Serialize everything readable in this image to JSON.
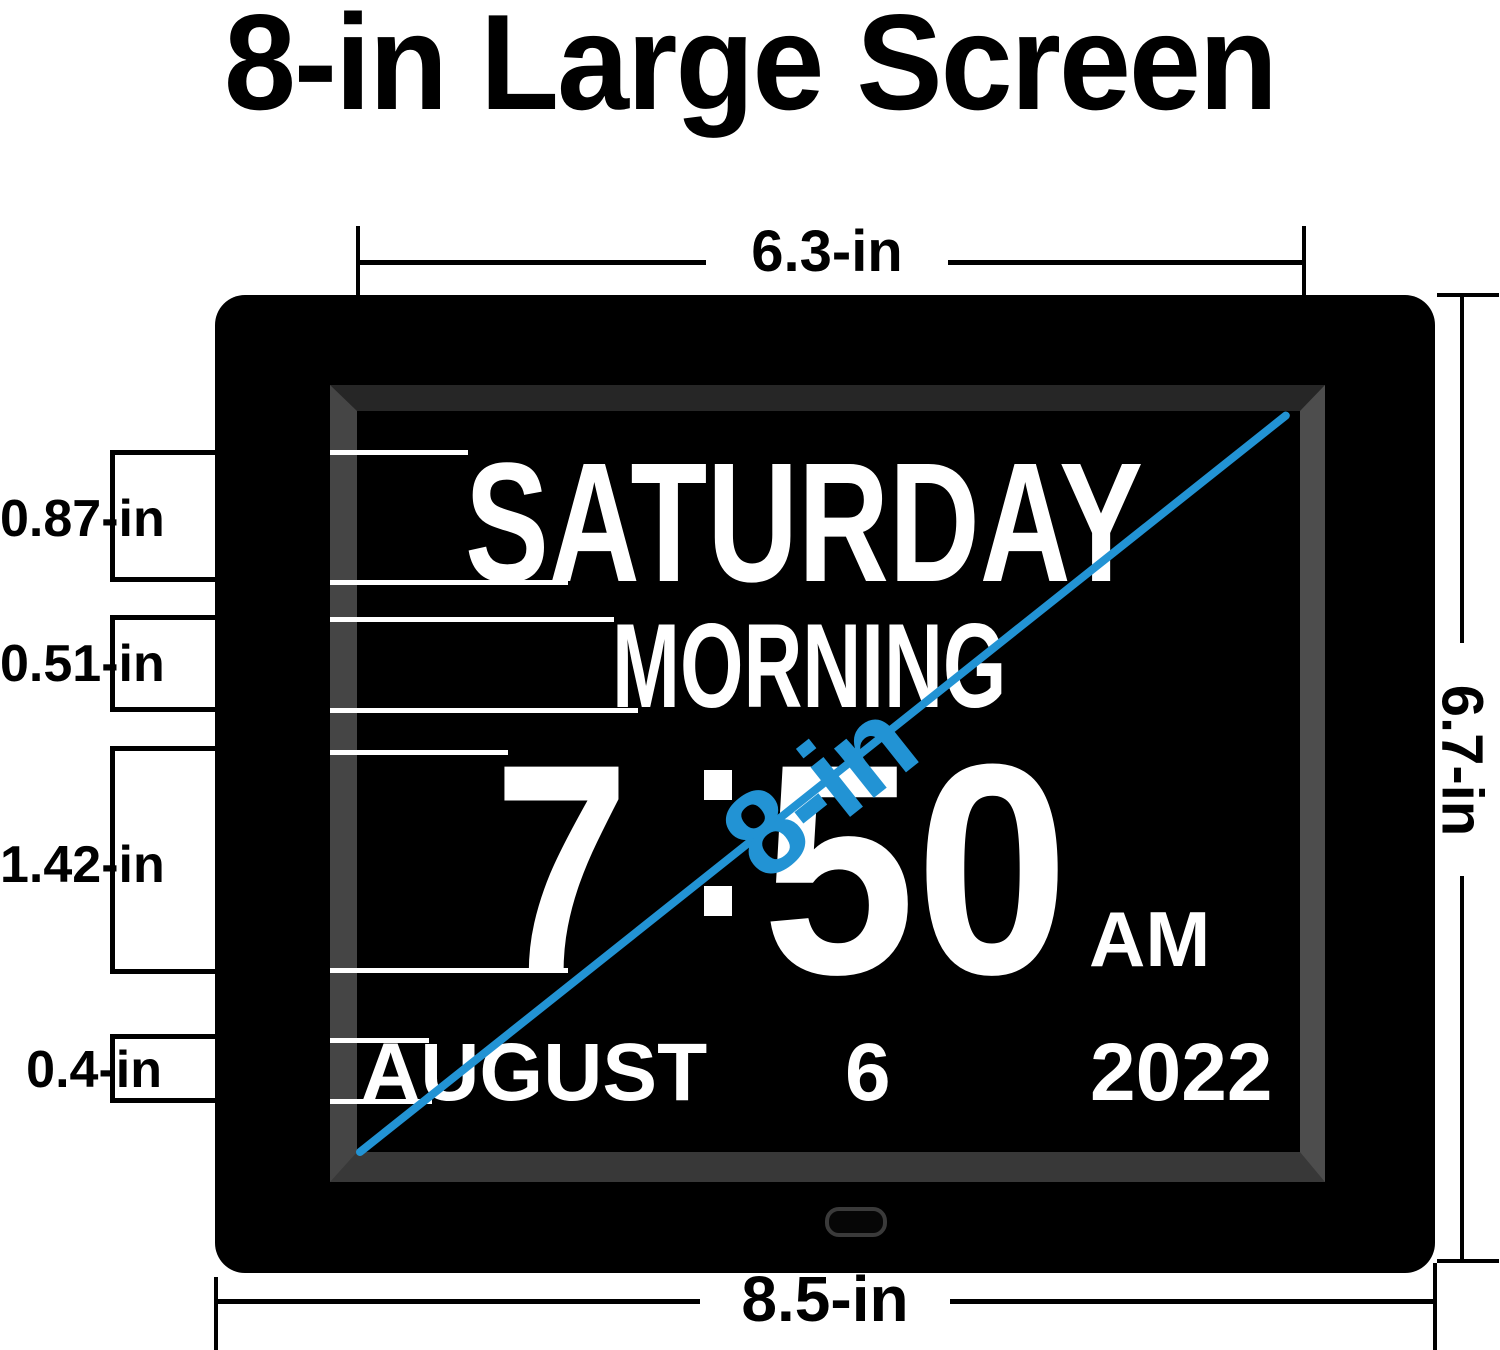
{
  "title": "8-in Large Screen",
  "clock": {
    "day": "SATURDAY",
    "period": "MORNING",
    "hour": "7",
    "minute": "50",
    "meridiem": "AM",
    "month": "AUGUST",
    "day_of_month": "6",
    "year": "2022"
  },
  "dimensions": {
    "screen_width": "6.3-in",
    "screen_height": "6.7-in",
    "device_width": "8.5-in",
    "screen_diagonal": "8-in",
    "row_heights": [
      {
        "label": "0.87-in"
      },
      {
        "label": "0.51-in"
      },
      {
        "label": "1.42-in"
      },
      {
        "label": "0.4-in"
      }
    ]
  },
  "colors": {
    "accent_blue": "#2293d4",
    "display_text": "#ffffff",
    "annotation": "#000000",
    "device_body": "#000000"
  }
}
